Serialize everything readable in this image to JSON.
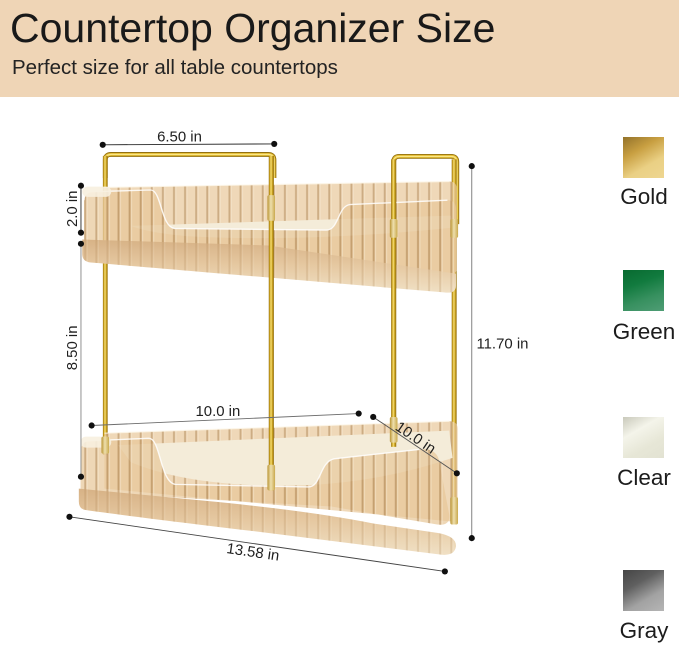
{
  "header": {
    "title": "Countertop Organizer Size",
    "subtitle": "Perfect size for all table countertops",
    "background": "#efd5b6"
  },
  "annotations": {
    "top_handle_width": "6.50 in",
    "top_tier_height": "2.0 in",
    "middle_gap_height": "8.50 in",
    "base_back_width": "10.0 in",
    "base_side_depth": "10.0 in",
    "total_height": "11.70 in",
    "base_front_width": "13.58 in"
  },
  "color_options": {
    "swatches": [
      {
        "label": "Gold",
        "angle": 150,
        "stops": [
          "#93722a",
          "#c89f41",
          "#ead084",
          "#eed691"
        ]
      },
      {
        "label": "Green",
        "angle": 160,
        "stops": [
          "#086a30",
          "#117a3e",
          "#37905f",
          "#4f9d75"
        ]
      },
      {
        "label": "Clear",
        "angle": 150,
        "stops": [
          "#c9c9bb",
          "#f4f4ea",
          "#e7e7d7",
          "#e2e2d2"
        ]
      },
      {
        "label": "Gray",
        "angle": 150,
        "stops": [
          "#454545",
          "#5f5f5f",
          "#a2a2a2",
          "#b5b5b5"
        ]
      }
    ]
  },
  "product_palette": {
    "amber_wall": "#e8c79a",
    "rib_line": "#a97f4e",
    "gold_metal": "#d9ab25",
    "tray_floor": "#f4ecd9"
  }
}
